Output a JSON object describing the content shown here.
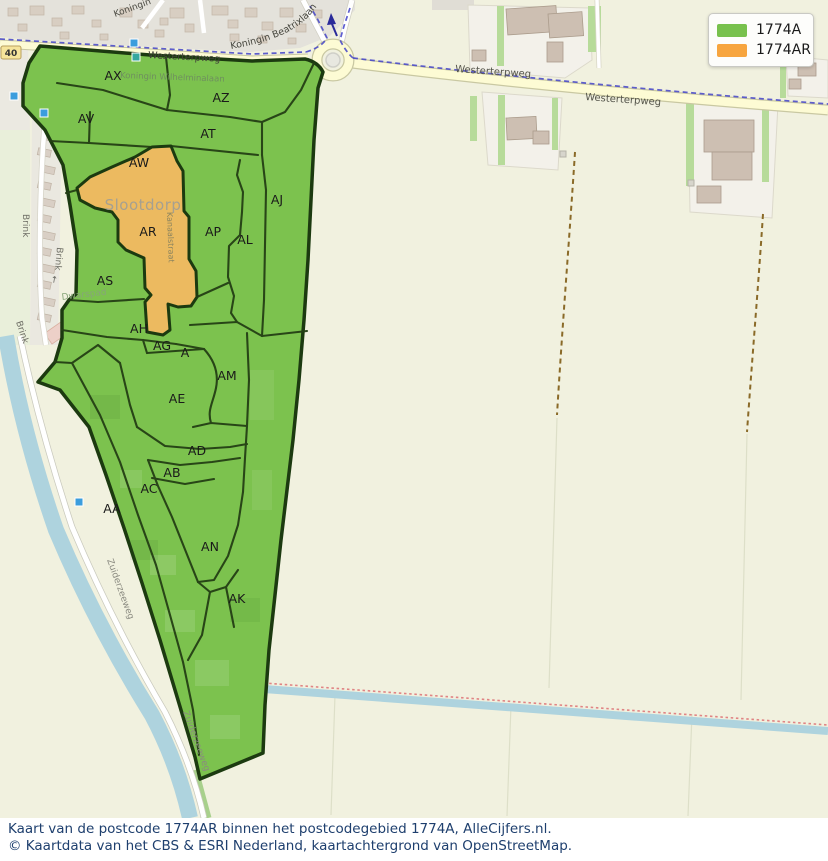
{
  "legend": {
    "items": [
      {
        "label": "1774A",
        "color": "#78c14d"
      },
      {
        "label": "1774AR",
        "color": "#f7a53f"
      }
    ]
  },
  "caption": {
    "line1": "Kaart van de postcode 1774AR binnen het postcodegebied 1774A, AlleCijfers.nl.",
    "line2": "© Kaartdata van het CBS & ESRI Nederland, kaartachtergrond van OpenStreetMap."
  },
  "map": {
    "place_label": "Slootdorp",
    "road_shield": "40",
    "curved_street_label": "Koningin Beatrixlaan",
    "region_labels": [
      {
        "code": "AX",
        "x": 113,
        "y": 80
      },
      {
        "code": "AZ",
        "x": 221,
        "y": 102
      },
      {
        "code": "AV",
        "x": 86,
        "y": 123
      },
      {
        "code": "AT",
        "x": 208,
        "y": 138
      },
      {
        "code": "AW",
        "x": 139,
        "y": 167
      },
      {
        "code": "AJ",
        "x": 277,
        "y": 204
      },
      {
        "code": "AR",
        "x": 148,
        "y": 236
      },
      {
        "code": "AP",
        "x": 213,
        "y": 236
      },
      {
        "code": "AL",
        "x": 245,
        "y": 244
      },
      {
        "code": "AS",
        "x": 105,
        "y": 285
      },
      {
        "code": "AH",
        "x": 139,
        "y": 333
      },
      {
        "code": "AG",
        "x": 162,
        "y": 350
      },
      {
        "code": "A",
        "x": 185,
        "y": 357
      },
      {
        "code": "AM",
        "x": 227,
        "y": 380
      },
      {
        "code": "AE",
        "x": 177,
        "y": 403
      },
      {
        "code": "AD",
        "x": 197,
        "y": 455
      },
      {
        "code": "AB",
        "x": 172,
        "y": 477
      },
      {
        "code": "AC",
        "x": 149,
        "y": 493
      },
      {
        "code": "AA",
        "x": 112,
        "y": 513
      },
      {
        "code": "AN",
        "x": 210,
        "y": 551
      },
      {
        "code": "AK",
        "x": 237,
        "y": 603
      }
    ],
    "street_labels": [
      {
        "text": "Westerterpweg",
        "x": 148,
        "y": 58,
        "rot": 3,
        "size": 9.5,
        "color": "#43433b"
      },
      {
        "text": "Westerterpweg",
        "x": 455,
        "y": 72,
        "rot": 4,
        "size": 10,
        "color": "#55554b"
      },
      {
        "text": "Westerterpweg",
        "x": 585,
        "y": 100,
        "rot": 4,
        "size": 10,
        "color": "#55554b"
      },
      {
        "text": "Koningin",
        "x": 115,
        "y": 17,
        "rot": -20,
        "size": 9,
        "color": "#4a4a42"
      },
      {
        "text": "Koningin Wilhelminalaan",
        "x": 120,
        "y": 78,
        "rot": 2,
        "size": 8.5,
        "color": "#6f8f5f"
      },
      {
        "text": "Brink",
        "x": 23,
        "y": 214,
        "rot": 90,
        "size": 9,
        "color": "#6f6f66"
      },
      {
        "text": "Brink",
        "x": 57,
        "y": 247,
        "rot": 95,
        "size": 9,
        "color": "#6f6f66"
      },
      {
        "text": "Brink",
        "x": 16,
        "y": 322,
        "rot": 72,
        "size": 9,
        "color": "#6f6f66"
      },
      {
        "text": "↑",
        "x": 50,
        "y": 282,
        "rot": 10,
        "size": 9,
        "color": "#666660"
      },
      {
        "text": "Zuiderzeeweg",
        "x": 107,
        "y": 560,
        "rot": 70,
        "size": 9,
        "color": "#8a8a80"
      },
      {
        "text": "Zuiderzeeweg",
        "x": 183,
        "y": 712,
        "rot": 70,
        "size": 9,
        "color": "#8a8a80"
      },
      {
        "text": "Kanaalstraat",
        "x": 167,
        "y": 212,
        "rot": 88,
        "size": 8,
        "color": "#8c845e"
      },
      {
        "text": "Dwarspad",
        "x": 62,
        "y": 300,
        "rot": -7,
        "size": 9,
        "color": "#87a578"
      }
    ],
    "markers": [
      {
        "x": 10,
        "y": 92,
        "color": "#3b9ddd"
      },
      {
        "x": 40,
        "y": 109,
        "color": "#3b9ddd"
      },
      {
        "x": 130,
        "y": 39,
        "color": "#3b9ddd"
      },
      {
        "x": 132,
        "y": 53,
        "color": "#35a79f"
      },
      {
        "x": 75,
        "y": 498,
        "color": "#3b9ddd"
      }
    ],
    "colors": {
      "region_fill": "#7cc24e",
      "region_border": "#1c3a10",
      "highlight_fill": "#ecba60",
      "water": "#aed3de",
      "road_yellow": "#fdfbd4",
      "farmland": "#f1f1df",
      "urban": "#e4e2db",
      "route_blue": "#4343c8",
      "route_red": "#e08484"
    }
  }
}
